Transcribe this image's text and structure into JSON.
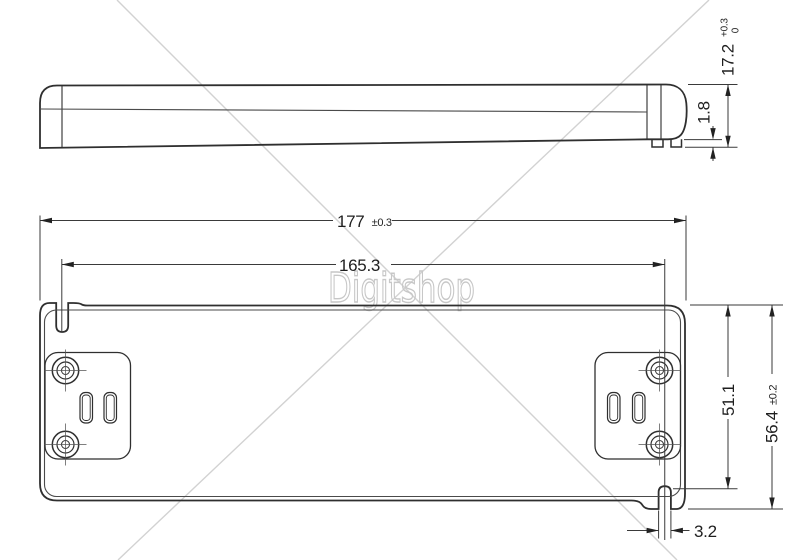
{
  "watermark": {
    "text": "Digitshop",
    "color": "#c7c7c7"
  },
  "side_view": {
    "dim_height": {
      "value": "17.2",
      "tol_plus": "+0.3",
      "tol_minus": "0"
    },
    "dim_foot_height": {
      "value": "1.8"
    }
  },
  "top_view": {
    "dim_overall_width": {
      "value": "177",
      "tol": "±0.3"
    },
    "dim_mounting_span": {
      "value": "165.3"
    },
    "dim_body_height": {
      "value": "51.1"
    },
    "dim_overall_height": {
      "value": "56.4",
      "tol": "±0.2"
    },
    "dim_slot_width": {
      "value": "3.2"
    }
  },
  "colors": {
    "object_line": "#2f2f2f",
    "thin_line": "#4a4a4a",
    "dim_line": "#3a3a3a",
    "watermark": "#c7c7c7",
    "background": "#ffffff"
  }
}
